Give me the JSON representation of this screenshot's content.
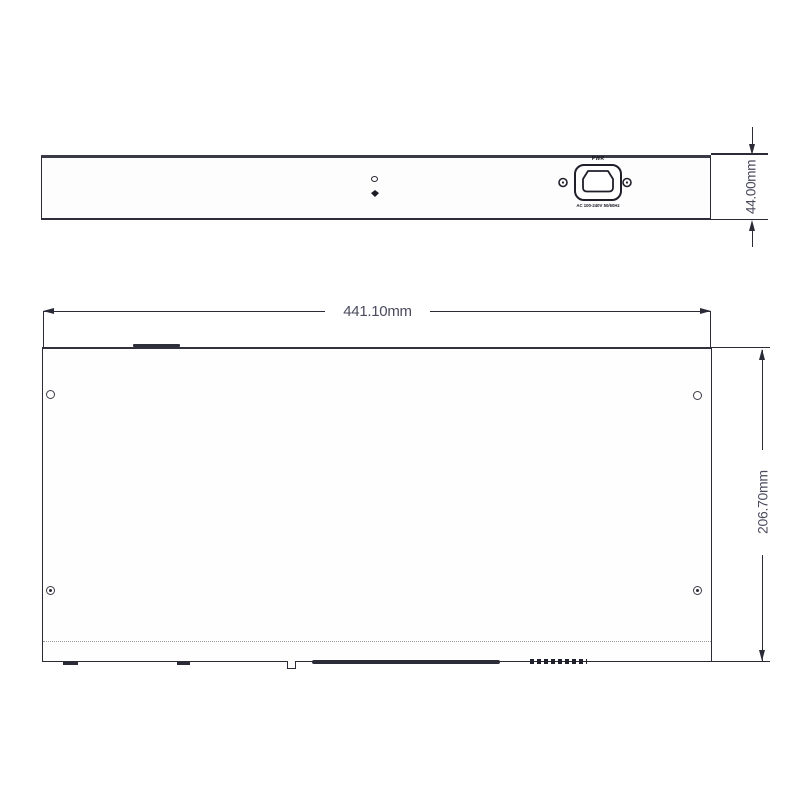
{
  "drawing": {
    "type": "mechanical-dimension-drawing",
    "units": "mm"
  },
  "rear_view": {
    "power_inlet": {
      "label": "PWR",
      "rating": "AC 100-240V 50/60Hz",
      "screw_holes": 2
    },
    "ground_marker": "chassis-ground-point",
    "height_dimension": {
      "label": "44.00mm",
      "value_mm": 44.0
    }
  },
  "top_view": {
    "screw_holes": 4,
    "width_dimension": {
      "label": "441.10mm",
      "value_mm": 441.1
    },
    "depth_dimension": {
      "label": "206.70mm",
      "value_mm": 206.7
    }
  },
  "colors": {
    "line": "#2b2b38",
    "line_heavy": "#34343f",
    "dim_text": "#4b4b5e",
    "dotted_line": "#9b9ba3",
    "background": "#ffffff"
  }
}
